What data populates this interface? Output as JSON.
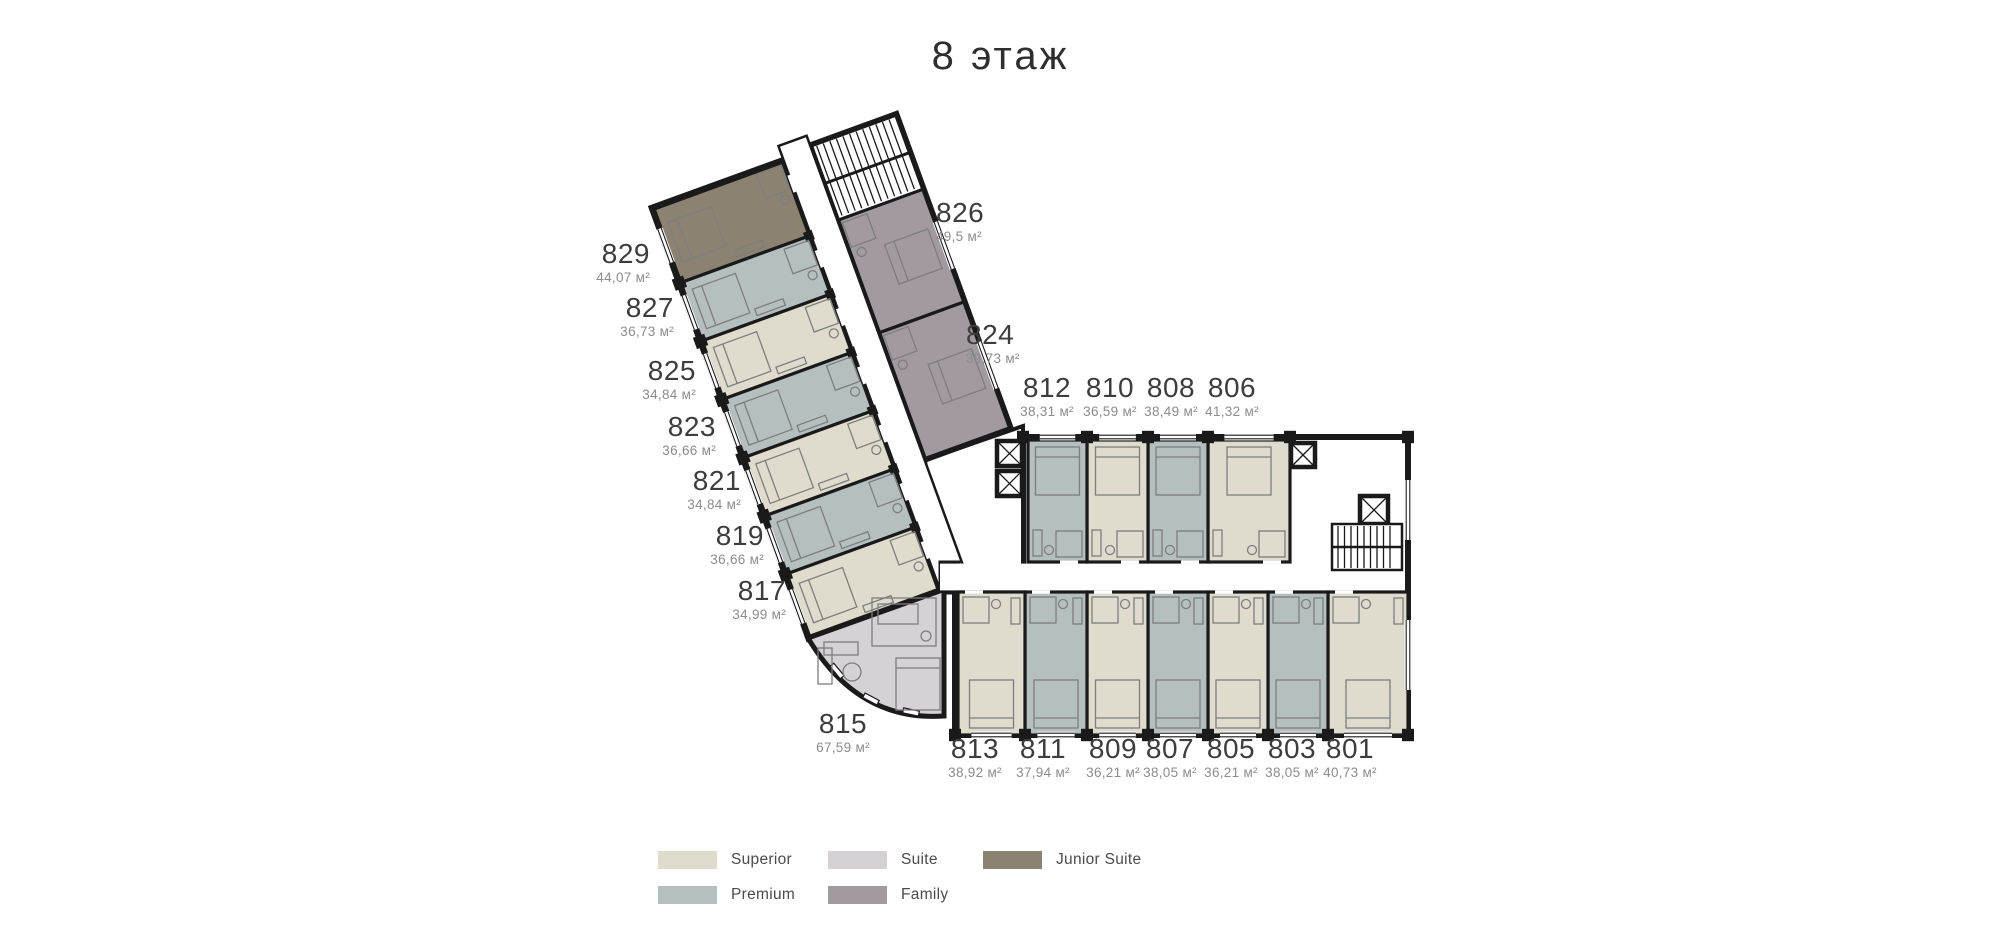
{
  "title": "8 этаж",
  "colors": {
    "superior": "#e0dccd",
    "premium": "#b5bfc0",
    "suite": "#d5d1d5",
    "family": "#a29aa0",
    "junior_suite": "#8b8272",
    "walls": "#1a1a1a",
    "furniture": "#7e7e7e",
    "room_number": "#3d3d3d",
    "room_area": "#8c8c8c"
  },
  "legend": {
    "items": [
      {
        "label": "Superior",
        "category": "superior"
      },
      {
        "label": "Premium",
        "category": "premium"
      },
      {
        "label": "Suite",
        "category": "suite"
      },
      {
        "label": "Family",
        "category": "family"
      },
      {
        "label": "Junior Suite",
        "category": "junior_suite"
      }
    ]
  },
  "rooms": [
    {
      "number": "829",
      "area": "44,07 м²",
      "category": "junior_suite"
    },
    {
      "number": "827",
      "area": "36,73 м²",
      "category": "premium"
    },
    {
      "number": "825",
      "area": "34,84 м²",
      "category": "superior"
    },
    {
      "number": "823",
      "area": "36,66 м²",
      "category": "premium"
    },
    {
      "number": "821",
      "area": "34,84 м²",
      "category": "superior"
    },
    {
      "number": "819",
      "area": "36,66 м²",
      "category": "premium"
    },
    {
      "number": "817",
      "area": "34,99 м²",
      "category": "superior"
    },
    {
      "number": "815",
      "area": "67,59 м²",
      "category": "suite"
    },
    {
      "number": "826",
      "area": "49,5 м²",
      "category": "family"
    },
    {
      "number": "824",
      "area": "39,73 м²",
      "category": "family"
    },
    {
      "number": "812",
      "area": "38,31 м²",
      "category": "premium"
    },
    {
      "number": "810",
      "area": "36,59 м²",
      "category": "superior"
    },
    {
      "number": "808",
      "area": "38,49 м²",
      "category": "premium"
    },
    {
      "number": "806",
      "area": "41,32 м²",
      "category": "superior"
    },
    {
      "number": "813",
      "area": "38,92 м²",
      "category": "superior"
    },
    {
      "number": "811",
      "area": "37,94 м²",
      "category": "premium"
    },
    {
      "number": "809",
      "area": "36,21 м²",
      "category": "superior"
    },
    {
      "number": "807",
      "area": "38,05 м²",
      "category": "premium"
    },
    {
      "number": "805",
      "area": "36,21 м²",
      "category": "superior"
    },
    {
      "number": "803",
      "area": "38,05 м²",
      "category": "premium"
    },
    {
      "number": "801",
      "area": "40,73 м²",
      "category": "superior"
    }
  ]
}
